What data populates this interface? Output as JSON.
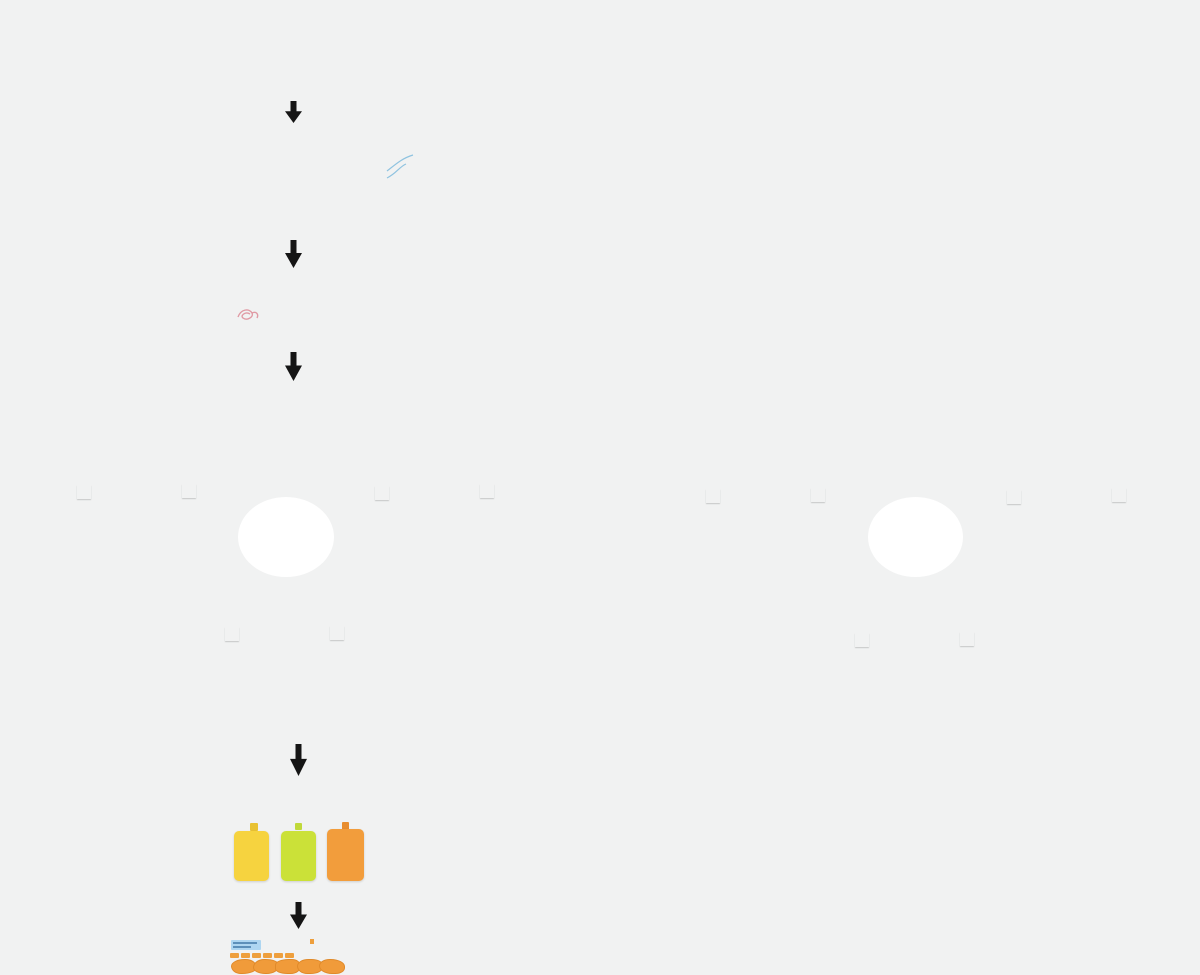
{
  "board": {
    "example_title": "Example",
    "marketplace_label": "Marketplace of Expectations",
    "steps": [
      "1",
      "2",
      "3",
      "4",
      "5"
    ]
  },
  "colors": {
    "background": "#f1f2f2",
    "cream_panel": "#f6eed6",
    "green_panel": "#dee8da",
    "blue_panel": "#cfe2f1",
    "toolbar_panel": "#d6e6ef",
    "table_bg": "#c2dbeb",
    "table_side": "#b7d3e6",
    "navy": "#1f4e79",
    "header_text_blue": "#6c9cc4",
    "card_cream": "#f8efdc",
    "card_border": "#e6d9bd",
    "label_blue": "#aed6f1",
    "chip_orange": "#ee9f3d",
    "chip_yellow": "#e9cb3f",
    "chip_green": "#c9dc61",
    "sticky_yellow": "#f6d33f",
    "sticky_green": "#cbe138",
    "sticky_orange": "#f29d3c",
    "mini_sticky_yellow": "#e9c83b",
    "arrow_black": "#151515",
    "step_navy": "#16334f",
    "blue_chip": "#a9d2ec",
    "tan_chip": "#ecdebc",
    "white_card": "#fdfdfc",
    "pink_scribble": "#e09aa4",
    "blob_orange": "#f09b3a"
  }
}
